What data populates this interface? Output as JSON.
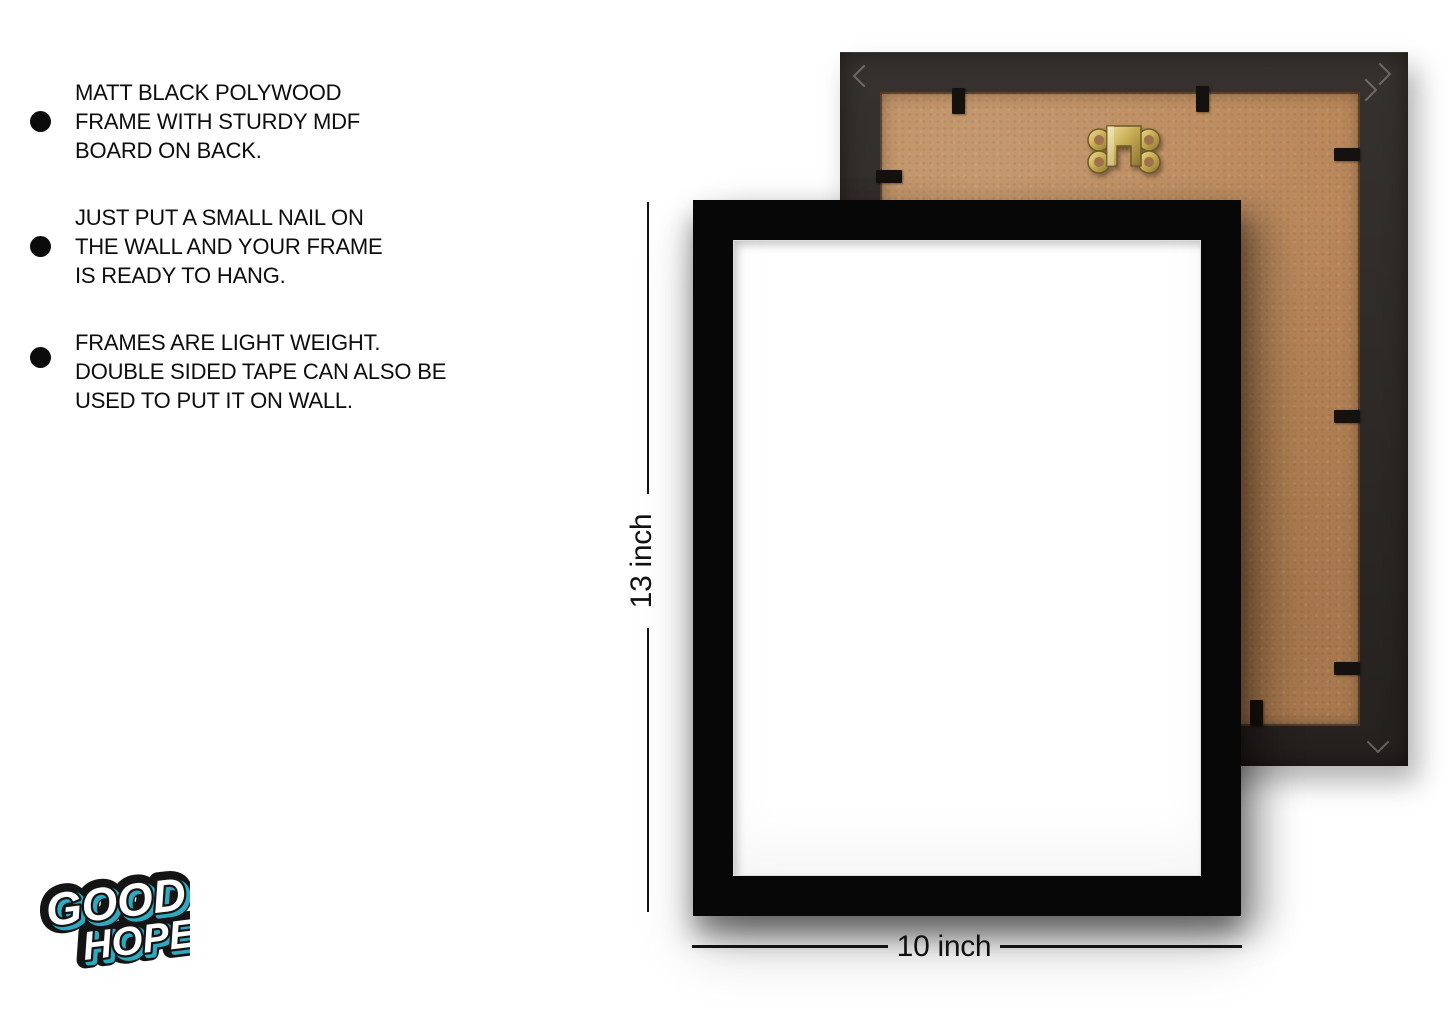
{
  "features": {
    "items": [
      {
        "lines": [
          "MATT BLACK POLYWOOD",
          "FRAME WITH STURDY MDF",
          "BOARD ON BACK."
        ]
      },
      {
        "lines": [
          "JUST PUT A SMALL NAIL ON",
          "THE WALL AND YOUR FRAME",
          "IS READY TO HANG."
        ]
      },
      {
        "lines": [
          "FRAMES ARE LIGHT WEIGHT.",
          "DOUBLE SIDED TAPE CAN ALSO BE",
          "USED TO PUT IT ON WALL."
        ]
      }
    ]
  },
  "dimensions": {
    "height_label": "13 inch",
    "width_label": "10 inch"
  },
  "logo": {
    "word1": "GOOD",
    "word2": "HOPE"
  },
  "icons": {
    "bullet": "filled-circle",
    "hanger": "brass-sawtooth-hanging-hook",
    "clips": "black-mounting-tabs"
  },
  "colors": {
    "page_bg": "#ffffff",
    "text": "#0d0d0d",
    "frame_black": "#070707",
    "back_frame_molding": "#2a2522",
    "mdf_board": "#b9875a",
    "hanger_gold": "#c9ae55",
    "logo_accent": "#2fa9c0"
  }
}
